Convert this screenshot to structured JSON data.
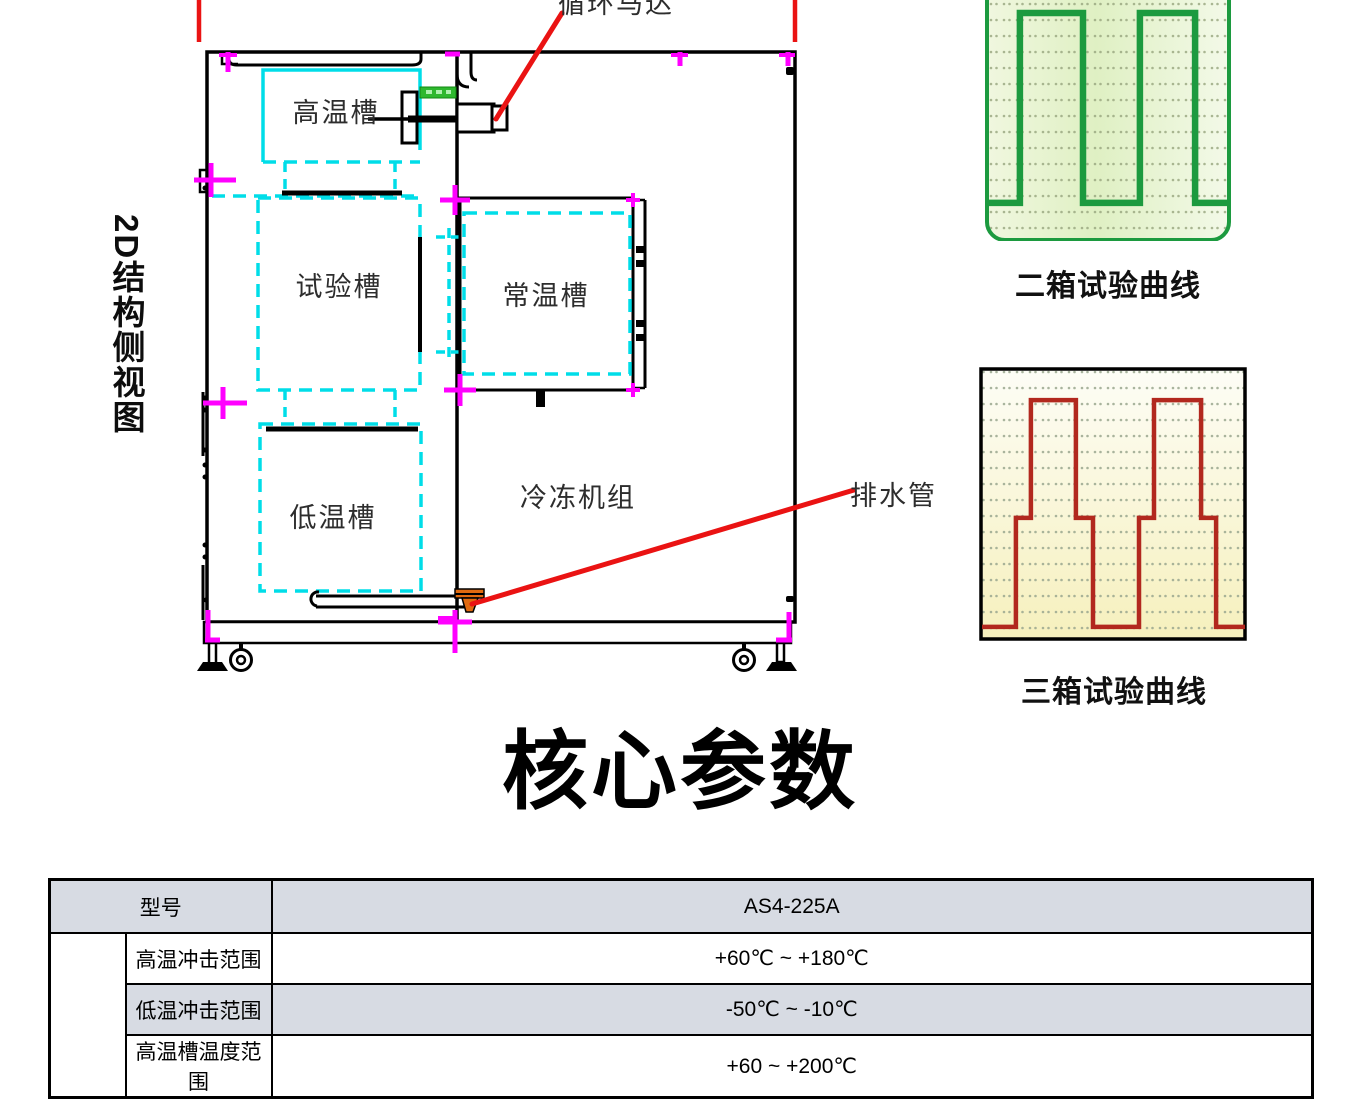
{
  "diagram": {
    "side_label": "2D结构侧视图",
    "annotations": {
      "motor": "循环马达",
      "drain": "排水管"
    },
    "chambers": {
      "high": "高温槽",
      "test": "试验槽",
      "ambient": "常温槽",
      "low": "低温槽",
      "refrigeration": "冷冻机组"
    },
    "colors": {
      "outline": "#000000",
      "chamber_dash": "#00dde8",
      "registration_mark": "#ff00ff",
      "leader_line": "#ea1313",
      "heater_block": "#2eb82e",
      "drain_fitting": "#e06a10"
    }
  },
  "chart_data": [
    {
      "type": "line",
      "title": "二箱试验曲线",
      "line_color": "#1c9a3f",
      "background": "light-green dotted grid, rounded green border, top edge cropped",
      "xlabel": "",
      "ylabel": "",
      "points": [
        [
          0,
          0.842
        ],
        [
          0.133,
          0.842
        ],
        [
          0.133,
          0.054
        ],
        [
          0.396,
          0.054
        ],
        [
          0.396,
          0.842
        ],
        [
          0.633,
          0.842
        ],
        [
          0.633,
          0.054
        ],
        [
          0.863,
          0.054
        ],
        [
          0.863,
          0.842
        ],
        [
          1,
          0.842
        ]
      ]
    },
    {
      "type": "line",
      "title": "三箱试验曲线",
      "line_color": "#b2281e",
      "background": "pale-yellow dotted grid, black square border",
      "xlabel": "",
      "ylabel": "",
      "points": [
        [
          0,
          0.952
        ],
        [
          0.129,
          0.952
        ],
        [
          0.129,
          0.551
        ],
        [
          0.186,
          0.551
        ],
        [
          0.186,
          0.118
        ],
        [
          0.357,
          0.118
        ],
        [
          0.357,
          0.551
        ],
        [
          0.422,
          0.551
        ],
        [
          0.422,
          0.952
        ],
        [
          0.597,
          0.952
        ],
        [
          0.597,
          0.551
        ],
        [
          0.654,
          0.551
        ],
        [
          0.654,
          0.118
        ],
        [
          0.833,
          0.118
        ],
        [
          0.833,
          0.551
        ],
        [
          0.89,
          0.551
        ],
        [
          0.89,
          0.952
        ],
        [
          1,
          0.952
        ]
      ]
    }
  ],
  "section_title": "核心参数",
  "table": {
    "header": {
      "label": "型号",
      "value": "AS4-225A"
    },
    "rows": [
      {
        "label": "高温冲击范围",
        "value": "+60℃ ~ +180℃",
        "shaded": false
      },
      {
        "label": "低温冲击范围",
        "value": "-50℃ ~ -10℃",
        "shaded": true
      },
      {
        "label": "高温槽温度范围",
        "value": "+60 ~ +200℃",
        "shaded": false
      }
    ],
    "row_shade_color": "#d7dbe3"
  }
}
